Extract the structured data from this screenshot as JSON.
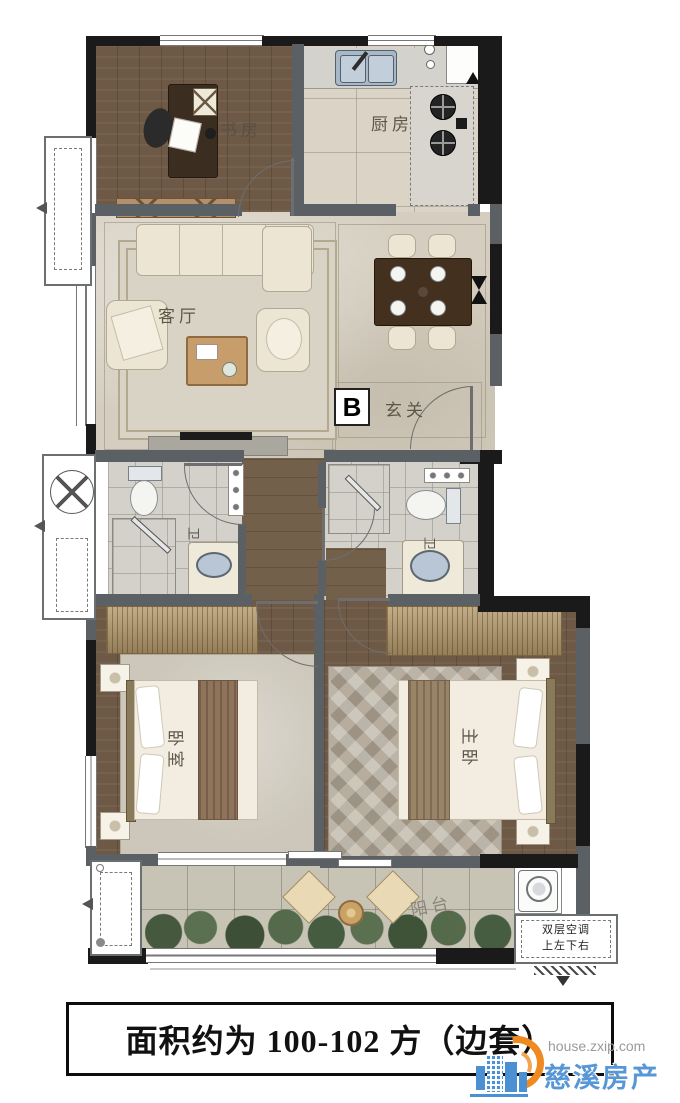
{
  "title_caption": "面积约为 100-102 方（边套）",
  "unit_badge": "B",
  "rooms": {
    "study": "书房",
    "kitchen": "厨房",
    "living": "客厅",
    "entry": "玄关",
    "bath_left": "卫",
    "bath_right": "卫",
    "bedroom": "卧室",
    "master": "主卧",
    "balcony": "阳台"
  },
  "annotations": {
    "ac_note_line1": "双层空调",
    "ac_note_line2": "上左下右"
  },
  "watermark": {
    "url": "house.zxip.com",
    "site": "慈溪房产网"
  },
  "colors": {
    "exterior_wall": "#1a1a1a",
    "interior_wall": "#5b6064",
    "wood_floor": "#6d5945",
    "marble_floor": "#d5cec0",
    "watermark_orange": "#ee8a20",
    "watermark_blue": "#4a90d2"
  }
}
